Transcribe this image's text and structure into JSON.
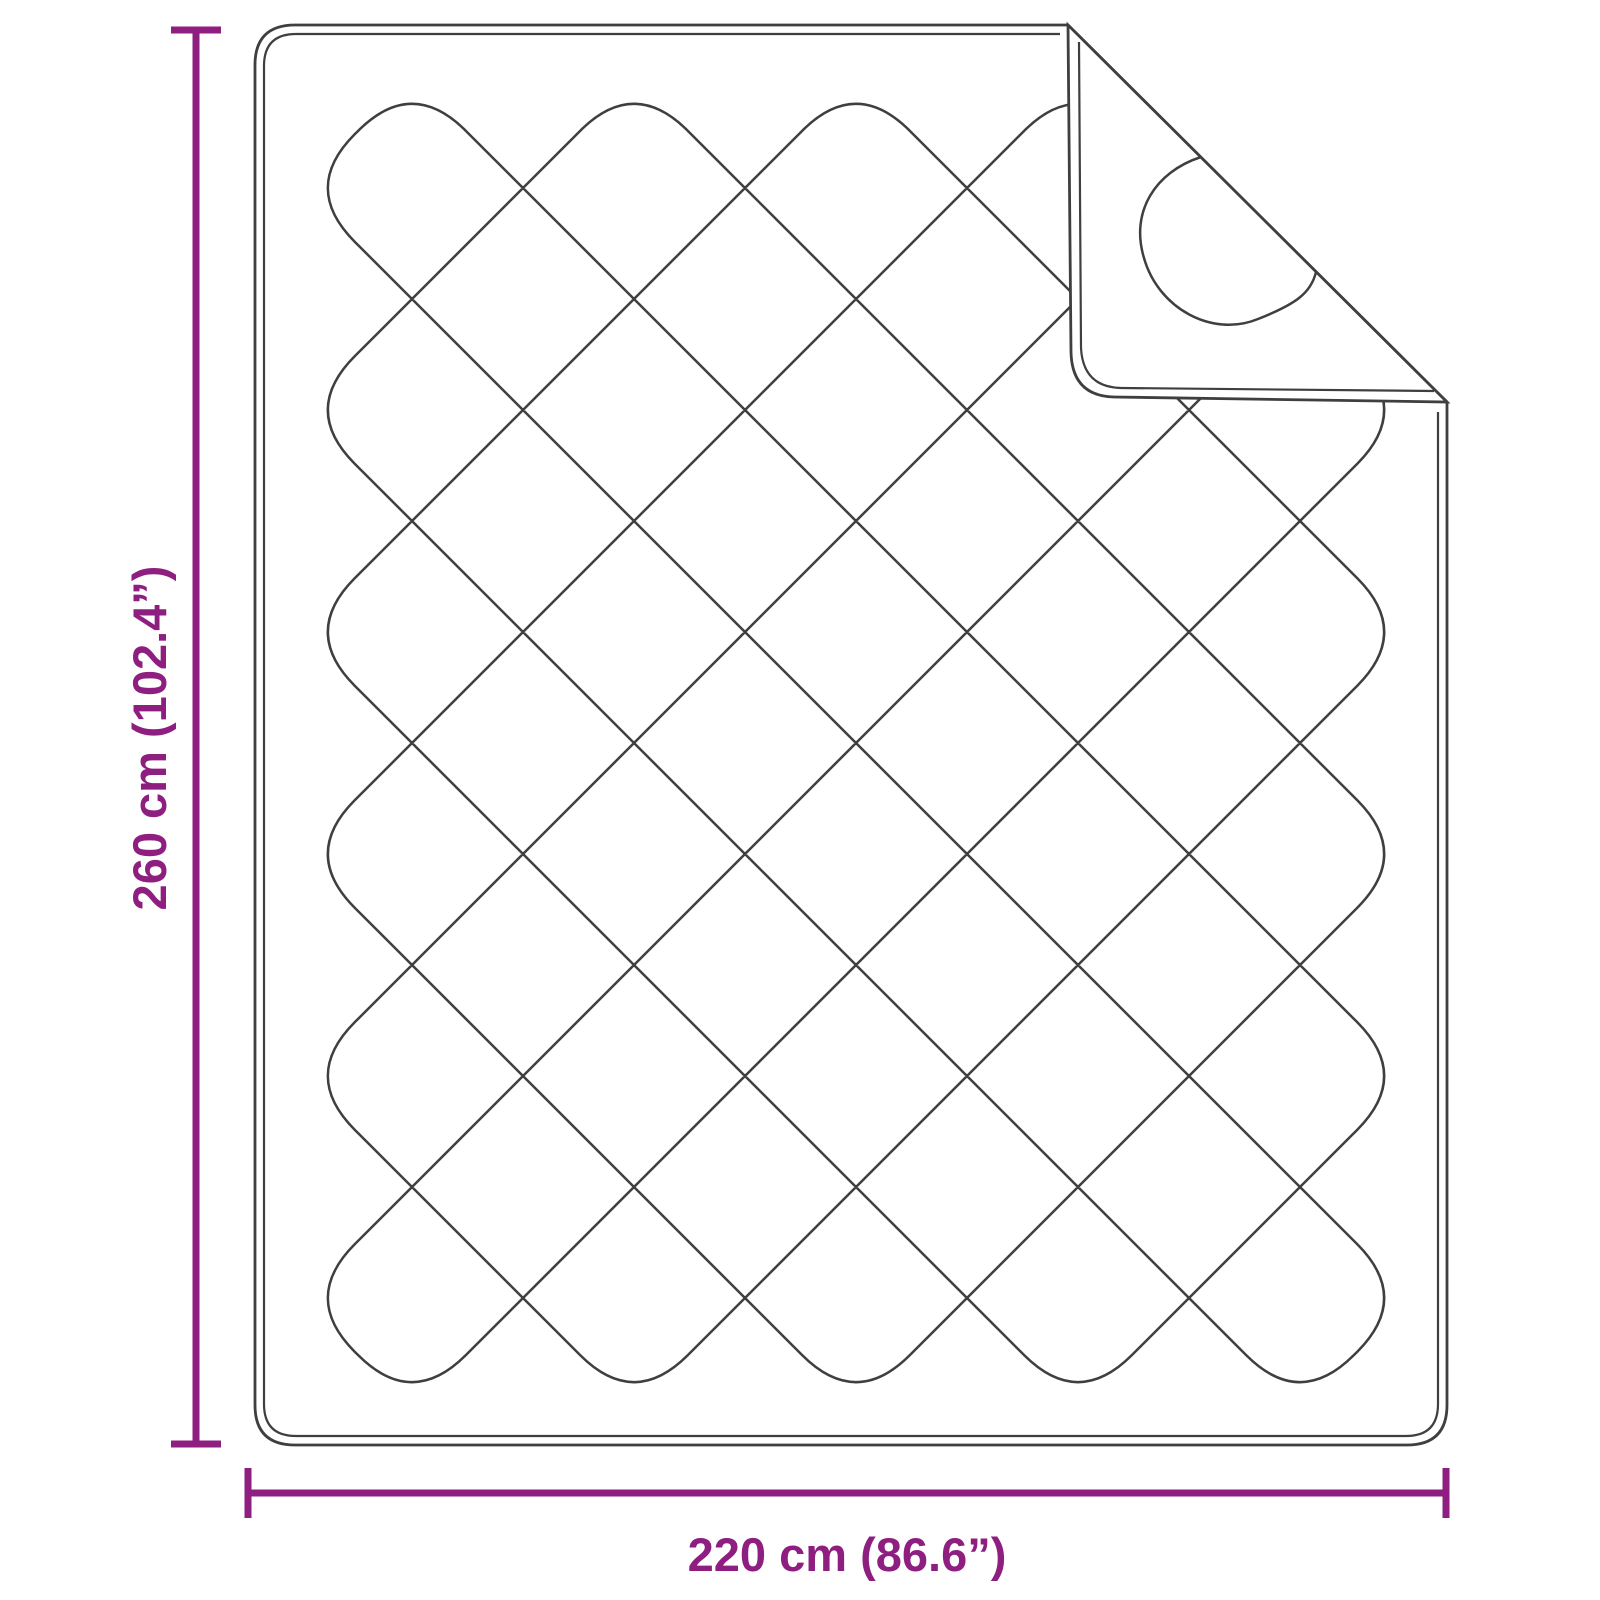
{
  "diagram": {
    "subject": "quilted-blanket-with-folded-corner"
  },
  "dimensions": {
    "height_label": "260 cm (102.4”)",
    "width_label": "220 cm (86.6”)"
  },
  "colors": {
    "accent": "#8e1f80",
    "line": "#3f3f3f",
    "background": "#ffffff"
  }
}
